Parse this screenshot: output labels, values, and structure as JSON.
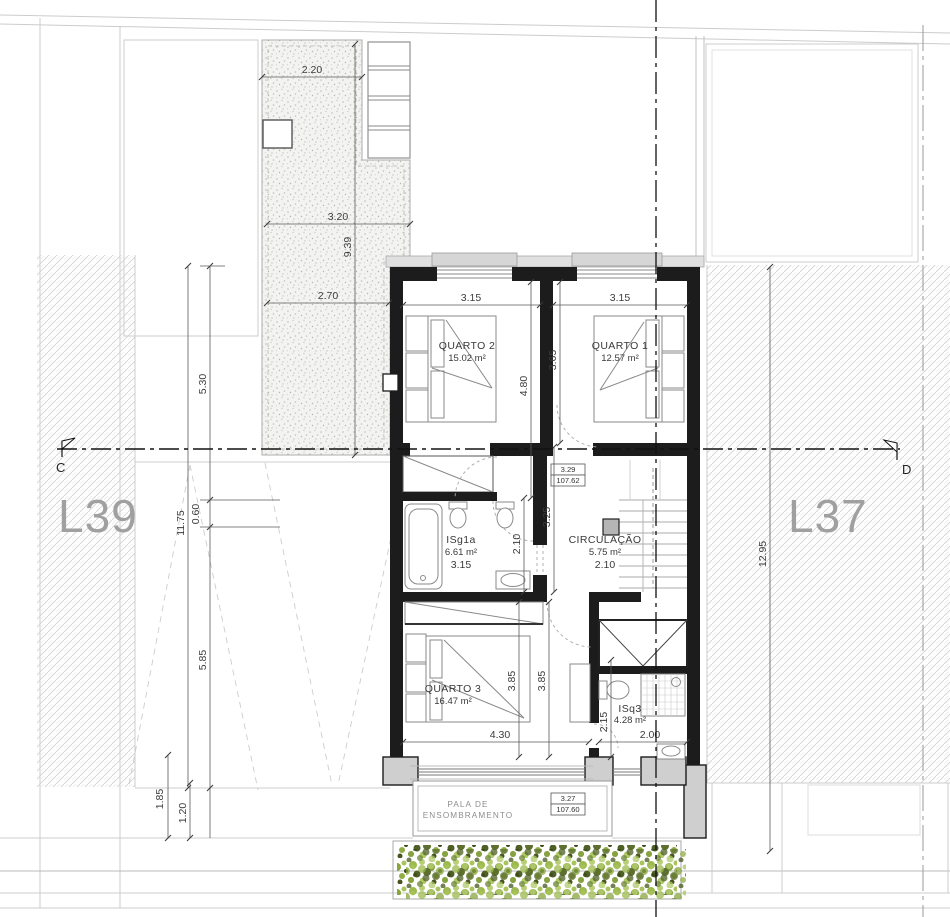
{
  "drawing": {
    "lot_left": "L39",
    "lot_right": "L37",
    "section_left": "C",
    "section_right": "D",
    "rooms": [
      {
        "name": "QUARTO 2",
        "area": "15.02 m²"
      },
      {
        "name": "QUARTO 1",
        "area": "12.57 m²"
      },
      {
        "name": "ISg1a",
        "area": "6.61 m²"
      },
      {
        "name": "CIRCULAÇÃO",
        "area": "5.75 m²"
      },
      {
        "name": "QUARTO 3",
        "area": "16.47 m²"
      },
      {
        "name": "ISq3",
        "area": "4.28 m²"
      }
    ],
    "levels": [
      {
        "height": "3.29",
        "elevation": "107.62"
      },
      {
        "height": "3.27",
        "elevation": "107.60"
      }
    ],
    "shade": {
      "line1": "PALA DE",
      "line2": "ENSOMBRAMENTO"
    },
    "dims": [
      "2.20",
      "3.20",
      "9.39",
      "2.70",
      "5.30",
      "0.60",
      "5.85",
      "11.75",
      "1.85",
      "1.20",
      "12.95",
      "3.15",
      "3.15",
      "4.80",
      "3.65",
      "3.25",
      "2.10",
      "3.15",
      "2.10",
      "3.85",
      "3.85",
      "4.30",
      "2.15",
      "2.00"
    ]
  },
  "colors": {
    "wall": "#1c1c1c",
    "wall_fill": "#cfcfcf",
    "hatch_line": "#d7d7d7",
    "gravel_dot": "#c4c4c4",
    "dim_text": "#3c3c3c",
    "lot_label": "#a0a0a0",
    "veg_light": "#aec75e",
    "veg_mid": "#8aa83e",
    "veg_dark": "#4c5c24"
  }
}
